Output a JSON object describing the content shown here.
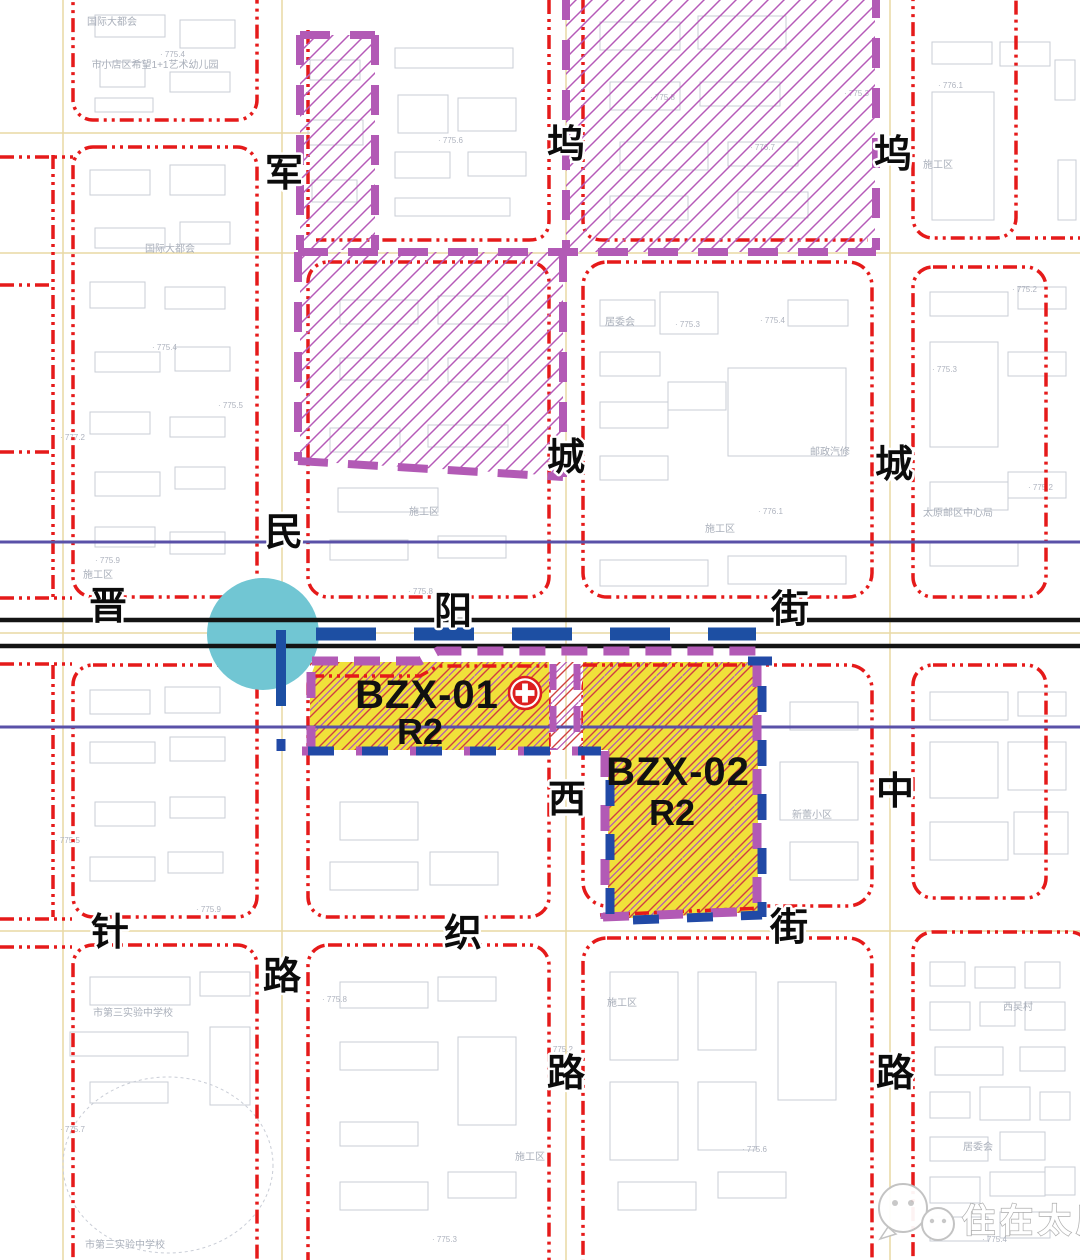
{
  "canvas": {
    "width": 1080,
    "height": 1260
  },
  "colors": {
    "road_redline": "#e51a1a",
    "boundary_purple": "#b25ab5",
    "zone_fill_yellow": "#f0e13a",
    "zone_hatch_red": "#cf4040",
    "zone_border_blue": "#2149a6",
    "metro_blue": "#1d4fa3",
    "station_cyan": "#71c6d3",
    "railway_black": "#141414",
    "planning_line_indigo": "#5a51a8",
    "road_centerline_tan": "#e9d9a4",
    "hospital_red": "#dc1f1f"
  },
  "streets": {
    "junmin": {
      "name": "军民路",
      "chars": [
        "军",
        "民",
        "路"
      ]
    },
    "wucheng_west": {
      "name": "坞城西路",
      "chars": [
        "坞",
        "城",
        "西",
        "路"
      ]
    },
    "wucheng_middle": {
      "name": "坞城中路",
      "chars": [
        "坞",
        "城",
        "中",
        "路"
      ]
    },
    "jinyang": {
      "name": "晋阳街",
      "chars": [
        "晋",
        "阳",
        "街"
      ]
    },
    "zhenzhi": {
      "name": "针织街",
      "chars": [
        "针",
        "织",
        "街"
      ]
    }
  },
  "zones": [
    {
      "id": "BZX-01",
      "use": "R2"
    },
    {
      "id": "BZX-02",
      "use": "R2"
    }
  ],
  "icons": {
    "hospital": "medical-cross-icon",
    "station": "metro-station-circle",
    "watermark_icon": "wechat-bubbles-icon"
  },
  "watermark": {
    "text": "住在太原"
  },
  "map": {
    "background_labels": [
      {
        "text": "国际大都会",
        "x": 112,
        "y": 25
      },
      {
        "text": "市小店区希望1+1艺术幼儿园",
        "x": 155,
        "y": 68
      },
      {
        "text": "国际大都会",
        "x": 170,
        "y": 252
      },
      {
        "text": "施工区",
        "x": 98,
        "y": 578
      },
      {
        "text": "施工区",
        "x": 424,
        "y": 515
      },
      {
        "text": "居委会",
        "x": 620,
        "y": 325
      },
      {
        "text": "邮政汽修",
        "x": 830,
        "y": 455
      },
      {
        "text": "施工区",
        "x": 720,
        "y": 532
      },
      {
        "text": "太原邮区中心局",
        "x": 958,
        "y": 516
      },
      {
        "text": "施工区",
        "x": 938,
        "y": 168
      },
      {
        "text": "新蕾小区",
        "x": 812,
        "y": 818
      },
      {
        "text": "施工区",
        "x": 622,
        "y": 1006
      },
      {
        "text": "市第三实验中学校",
        "x": 133,
        "y": 1016
      },
      {
        "text": "市第三实验中学校",
        "x": 125,
        "y": 1248
      },
      {
        "text": "西吴村",
        "x": 1018,
        "y": 1010
      },
      {
        "text": "居委会",
        "x": 978,
        "y": 1150
      },
      {
        "text": "施工区",
        "x": 530,
        "y": 1160
      }
    ],
    "elevation_marks": [
      {
        "t": "775.4",
        "x": 160,
        "y": 57
      },
      {
        "t": "775.6",
        "x": 438,
        "y": 143
      },
      {
        "t": "775.8",
        "x": 650,
        "y": 100
      },
      {
        "t": "776.1",
        "x": 938,
        "y": 88
      },
      {
        "t": "775.3",
        "x": 675,
        "y": 327
      },
      {
        "t": "775.4",
        "x": 760,
        "y": 323
      },
      {
        "t": "775.3",
        "x": 932,
        "y": 372
      },
      {
        "t": "775.2",
        "x": 1028,
        "y": 490
      },
      {
        "t": "776.1",
        "x": 758,
        "y": 514
      },
      {
        "t": "775.9",
        "x": 95,
        "y": 563
      },
      {
        "t": "775.8",
        "x": 408,
        "y": 594
      },
      {
        "t": "775.4",
        "x": 152,
        "y": 350
      },
      {
        "t": "775.5",
        "x": 218,
        "y": 408
      },
      {
        "t": "777.2",
        "x": 60,
        "y": 440
      },
      {
        "t": "776.7",
        "x": 750,
        "y": 150
      },
      {
        "t": "775.3",
        "x": 844,
        "y": 96
      },
      {
        "t": "775.2",
        "x": 1012,
        "y": 292
      },
      {
        "t": "775.5",
        "x": 55,
        "y": 843
      },
      {
        "t": "775.9",
        "x": 196,
        "y": 912
      },
      {
        "t": "775.8",
        "x": 322,
        "y": 1002
      },
      {
        "t": "775.2",
        "x": 548,
        "y": 1052
      },
      {
        "t": "775.6",
        "x": 742,
        "y": 1152
      },
      {
        "t": "775.3",
        "x": 432,
        "y": 1242
      },
      {
        "t": "775.4",
        "x": 982,
        "y": 1242
      },
      {
        "t": "775.7",
        "x": 60,
        "y": 1132
      },
      {
        "t": "775.1",
        "x": 736,
        "y": 688
      }
    ],
    "buildings": [
      [
        95,
        15,
        70,
        22
      ],
      [
        180,
        20,
        55,
        28
      ],
      [
        100,
        62,
        45,
        25
      ],
      [
        170,
        72,
        60,
        20
      ],
      [
        95,
        98,
        58,
        14
      ],
      [
        90,
        170,
        60,
        25
      ],
      [
        170,
        165,
        55,
        30
      ],
      [
        95,
        228,
        70,
        20
      ],
      [
        180,
        222,
        50,
        22
      ],
      [
        90,
        282,
        55,
        26
      ],
      [
        165,
        287,
        60,
        22
      ],
      [
        95,
        352,
        65,
        20
      ],
      [
        175,
        347,
        55,
        24
      ],
      [
        90,
        412,
        60,
        22
      ],
      [
        170,
        417,
        55,
        20
      ],
      [
        95,
        472,
        65,
        24
      ],
      [
        175,
        467,
        50,
        22
      ],
      [
        95,
        527,
        60,
        20
      ],
      [
        170,
        532,
        55,
        22
      ],
      [
        395,
        48,
        118,
        20
      ],
      [
        398,
        95,
        50,
        38
      ],
      [
        458,
        98,
        58,
        33
      ],
      [
        395,
        152,
        55,
        26
      ],
      [
        468,
        152,
        58,
        24
      ],
      [
        395,
        198,
        115,
        18
      ],
      [
        310,
        60,
        50,
        20
      ],
      [
        308,
        120,
        55,
        25
      ],
      [
        312,
        180,
        45,
        22
      ],
      [
        340,
        300,
        78,
        24
      ],
      [
        438,
        296,
        70,
        28
      ],
      [
        340,
        358,
        88,
        22
      ],
      [
        448,
        358,
        60,
        24
      ],
      [
        330,
        428,
        70,
        24
      ],
      [
        428,
        425,
        80,
        22
      ],
      [
        338,
        488,
        100,
        24
      ],
      [
        330,
        540,
        78,
        20
      ],
      [
        438,
        536,
        68,
        22
      ],
      [
        600,
        22,
        80,
        28
      ],
      [
        698,
        16,
        88,
        33
      ],
      [
        610,
        82,
        70,
        28
      ],
      [
        700,
        82,
        80,
        24
      ],
      [
        620,
        142,
        88,
        28
      ],
      [
        728,
        142,
        70,
        24
      ],
      [
        610,
        196,
        78,
        24
      ],
      [
        738,
        192,
        70,
        26
      ],
      [
        600,
        300,
        55,
        26
      ],
      [
        660,
        292,
        58,
        42
      ],
      [
        600,
        352,
        60,
        24
      ],
      [
        600,
        402,
        68,
        26
      ],
      [
        600,
        456,
        68,
        24
      ],
      [
        668,
        382,
        58,
        28
      ],
      [
        728,
        368,
        118,
        88
      ],
      [
        788,
        300,
        60,
        26
      ],
      [
        600,
        560,
        108,
        26
      ],
      [
        728,
        556,
        118,
        28
      ],
      [
        932,
        42,
        60,
        22
      ],
      [
        932,
        92,
        62,
        128
      ],
      [
        1000,
        42,
        50,
        24
      ],
      [
        930,
        292,
        78,
        24
      ],
      [
        1018,
        287,
        48,
        22
      ],
      [
        930,
        342,
        68,
        105
      ],
      [
        1008,
        352,
        58,
        24
      ],
      [
        930,
        482,
        78,
        28
      ],
      [
        1008,
        472,
        58,
        26
      ],
      [
        930,
        542,
        88,
        24
      ],
      [
        930,
        692,
        78,
        28
      ],
      [
        1018,
        692,
        48,
        24
      ],
      [
        930,
        742,
        68,
        56
      ],
      [
        1008,
        742,
        58,
        48
      ],
      [
        930,
        822,
        78,
        38
      ],
      [
        1014,
        812,
        54,
        42
      ],
      [
        90,
        690,
        60,
        24
      ],
      [
        165,
        687,
        55,
        26
      ],
      [
        90,
        742,
        65,
        21
      ],
      [
        170,
        737,
        55,
        24
      ],
      [
        95,
        802,
        60,
        24
      ],
      [
        170,
        797,
        55,
        21
      ],
      [
        90,
        857,
        65,
        24
      ],
      [
        168,
        852,
        55,
        21
      ],
      [
        90,
        977,
        100,
        28
      ],
      [
        200,
        972,
        50,
        24
      ],
      [
        70,
        1032,
        118,
        24
      ],
      [
        210,
        1027,
        40,
        78
      ],
      [
        90,
        1082,
        78,
        21
      ],
      [
        340,
        802,
        78,
        38
      ],
      [
        330,
        862,
        88,
        28
      ],
      [
        430,
        852,
        68,
        33
      ],
      [
        340,
        982,
        88,
        26
      ],
      [
        438,
        977,
        58,
        24
      ],
      [
        340,
        1042,
        98,
        28
      ],
      [
        458,
        1037,
        58,
        88
      ],
      [
        340,
        1122,
        78,
        24
      ],
      [
        340,
        1182,
        88,
        28
      ],
      [
        448,
        1172,
        68,
        26
      ],
      [
        610,
        972,
        68,
        88
      ],
      [
        698,
        972,
        58,
        78
      ],
      [
        610,
        1082,
        68,
        78
      ],
      [
        698,
        1082,
        58,
        68
      ],
      [
        778,
        982,
        58,
        118
      ],
      [
        618,
        1182,
        78,
        28
      ],
      [
        718,
        1172,
        68,
        26
      ],
      [
        790,
        702,
        68,
        28
      ],
      [
        780,
        762,
        78,
        58
      ],
      [
        790,
        842,
        68,
        38
      ],
      [
        930,
        962,
        35,
        24
      ],
      [
        975,
        967,
        40,
        21
      ],
      [
        1025,
        962,
        35,
        26
      ],
      [
        930,
        1002,
        40,
        28
      ],
      [
        980,
        1002,
        35,
        24
      ],
      [
        1025,
        1002,
        40,
        28
      ],
      [
        935,
        1047,
        68,
        28
      ],
      [
        1020,
        1047,
        45,
        24
      ],
      [
        930,
        1092,
        40,
        26
      ],
      [
        980,
        1087,
        50,
        33
      ],
      [
        1040,
        1092,
        30,
        28
      ],
      [
        930,
        1137,
        58,
        24
      ],
      [
        1000,
        1132,
        45,
        28
      ],
      [
        930,
        1177,
        50,
        26
      ],
      [
        990,
        1172,
        55,
        24
      ],
      [
        1045,
        1167,
        30,
        28
      ],
      [
        930,
        1217,
        58,
        24
      ],
      [
        1000,
        1212,
        50,
        26
      ],
      [
        1055,
        60,
        20,
        40
      ],
      [
        1058,
        160,
        18,
        60
      ]
    ]
  }
}
